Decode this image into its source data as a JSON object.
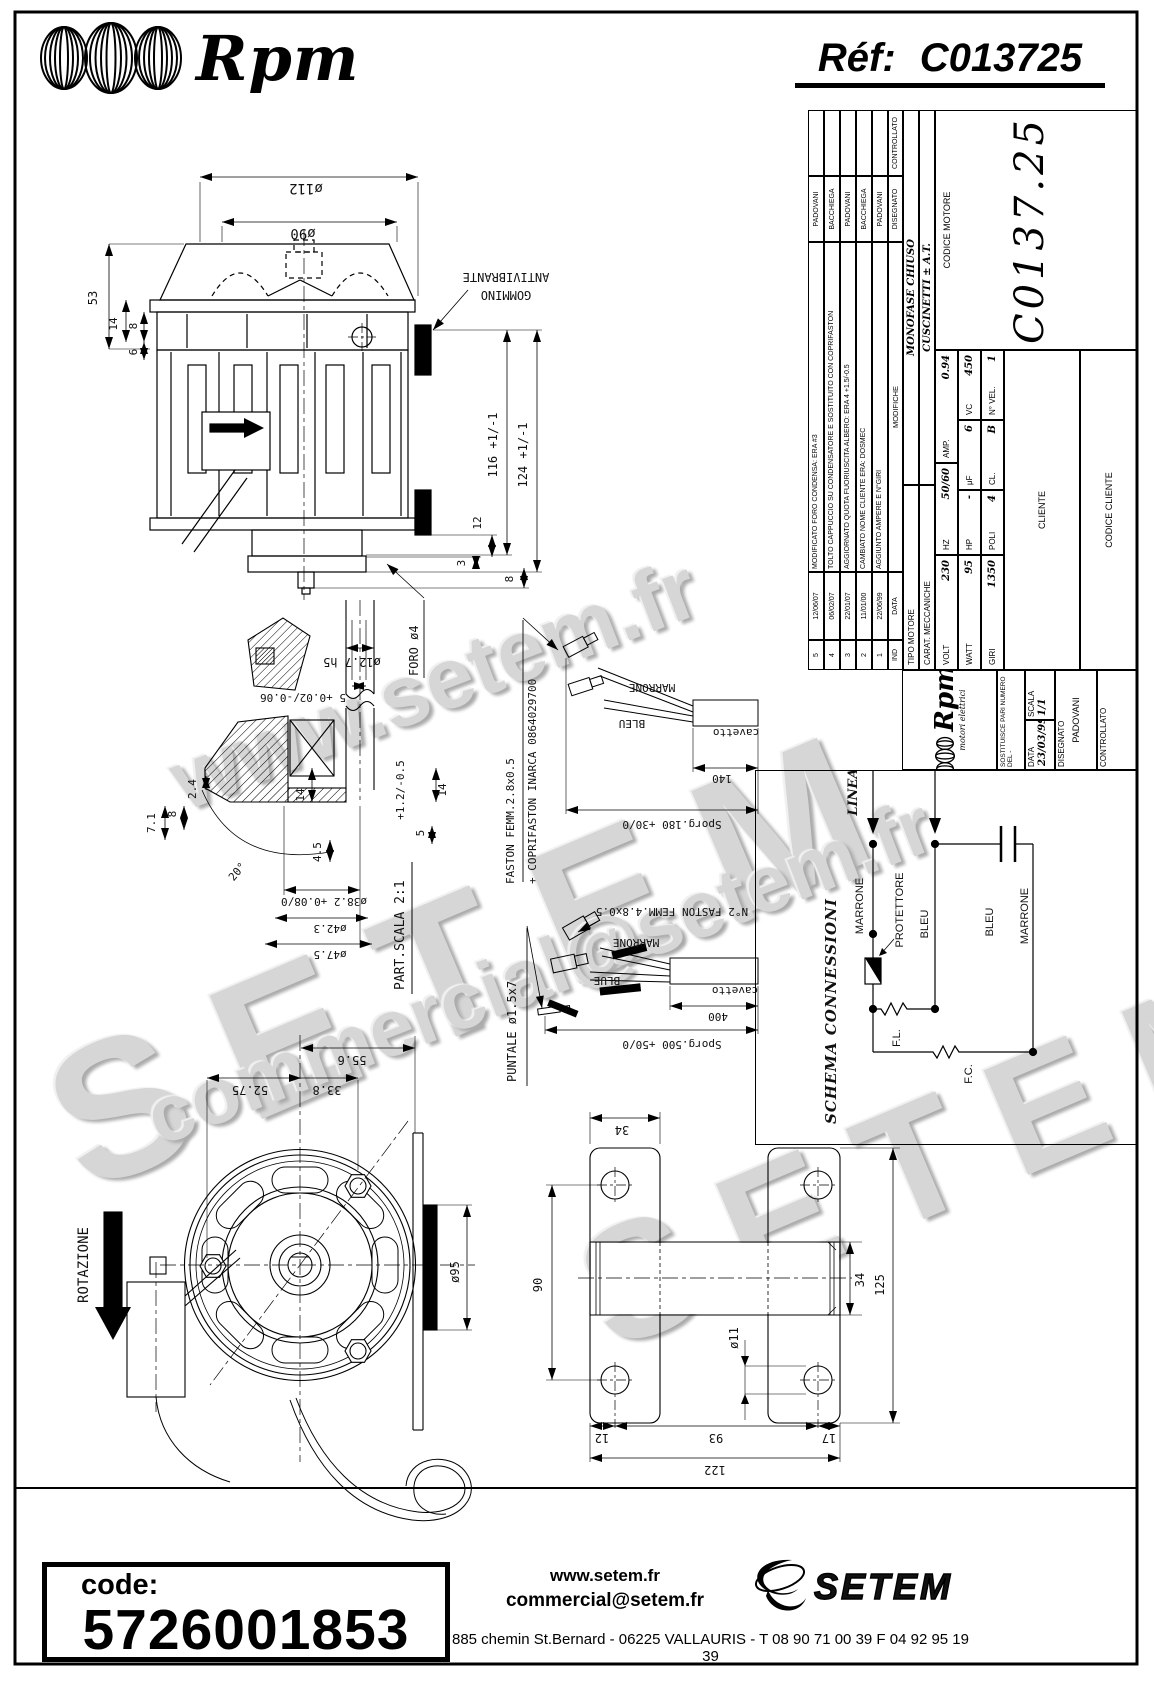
{
  "header": {
    "brand": "Rpm",
    "ref_label": "Réf:",
    "ref_value": "C013725"
  },
  "wm": {
    "a": "www.setem.fr",
    "b": "SETEM",
    "c": "commercial@setem.fr",
    "d": "SETEM"
  },
  "side": {
    "d112": "ø112",
    "d90": "ø90",
    "d53": "53",
    "d14": "14",
    "d8": "8",
    "d6": "6",
    "d116": "116 +1/-1",
    "d124": "124 +1/-1",
    "d12": "12",
    "d3": "3",
    "d8b": "8",
    "gommino1": "GOMMINO",
    "gommino2": "ANTIVIBRANTE",
    "foro": "FORO ø4"
  },
  "detail": {
    "title": "PART.SCALA 2:1",
    "d1": "ø12.7 h5",
    "d2": "5 +0.02/-0.06",
    "d3": "2.4",
    "d4": "7.1",
    "d5": "8",
    "d6": "14",
    "d7": "4.5",
    "d8": "20°",
    "d9": "+1.2/-0.5",
    "d10": "14",
    "d11": "5",
    "d12": "ø38.2 +0.08/0",
    "d13": "ø42.3",
    "d14": "ø47.5"
  },
  "cab1": {
    "l1": "FASTON FEMM.2.8x0.5",
    "l2": "+ COPRIFASTON INARCA 0864029700",
    "marrone": "MARRONE",
    "bleu": "BLEU",
    "cavetto": "cavetto",
    "len": "140",
    "sporg": "Sporg.180 +30/0"
  },
  "cab2": {
    "l1": "N°2 FASTON FEMM.4.8x0.5",
    "puntale": "PUNTALE ø1.5x7",
    "marrone": "MARRONE",
    "blue": "BLUE",
    "cavetto": "cavetto",
    "len": "400",
    "sporg": "Sporg.500 +50/0"
  },
  "front": {
    "rotazione": "ROTAZIONE",
    "d556": "55.6",
    "d5275": "52.75",
    "d338": "33.8",
    "d95": "ø95"
  },
  "bracket": {
    "d34t": "34",
    "d90": "90",
    "d11": "ø11",
    "d34r": "34",
    "d125": "125",
    "d12": "12",
    "d93": "93",
    "d17": "17",
    "d122": "122"
  },
  "schema": {
    "title": "SCHEMA CONNESSIONI",
    "linea": "LINEA",
    "marrone1": "MARRONE",
    "protettore": "PROTETTORE",
    "bleu1": "BLEU",
    "bleu2": "BLEU",
    "marrone2": "MARRONE",
    "fl": "F.L.",
    "fc": "F.C."
  },
  "tb": {
    "rev": [
      {
        "ind": "5",
        "data": "12/06/07",
        "mod": "MODIFICATO FORO CONDENSA: ERA #3",
        "dis": "PADOVANI"
      },
      {
        "ind": "4",
        "data": "06/02/07",
        "mod": "TOLTO CAPPUCCIO SU CONDENSATORE E SOSTITUITO CON COPRIFASTON",
        "dis": "BACCHIEGA"
      },
      {
        "ind": "3",
        "data": "22/01/07",
        "mod": "AGGIORNATO QUOTA FUORIUSCITA ALBERO: ERA 4 +1.5/-0.5",
        "dis": "PADOVANI"
      },
      {
        "ind": "2",
        "data": "11/01/00",
        "mod": "CAMBIATO NOME CLIENTE ERA: DOSMEC",
        "dis": "BACCHIEGA"
      },
      {
        "ind": "1",
        "data": "22/06/99",
        "mod": "AGGIUNTO AMPERE E N°GIRI",
        "dis": "PADOVANI"
      }
    ],
    "revh": {
      "ind": "IND",
      "data": "DATA",
      "mod": "MODIFICHE",
      "dis": "DISEGNATO",
      "ctrl": "CONTROLLATO"
    },
    "tipo_l": "TIPO MOTORE",
    "tipo_v": "MONOFASE CHIUSO",
    "carat_l": "CARAT. MECCANICHE",
    "carat_v": "CUSCINETTI ± A.T.",
    "volt_l": "VOLT",
    "volt": "230",
    "hz_l": "HZ",
    "hz": "50/60",
    "amp_l": "AMP.",
    "amp": "0.94",
    "watt_l": "WATT",
    "watt": "95",
    "hp_l": "HP",
    "hp": "-",
    "uf_l": "μF",
    "uf": "6",
    "vc_l": "VC",
    "vc": "450",
    "giri_l": "GIRI",
    "giri": "1350",
    "poli_l": "POLI",
    "poli": "4",
    "cl_l": "CL.",
    "cl": "B",
    "nvel_l": "N° VEL.",
    "nvel": "1",
    "cliente_l": "CLIENTE",
    "cod_cliente_l": "CODICE CLIENTE",
    "cod_motore_l": "CODICE MOTORE",
    "cod_motore": "C0137.25",
    "brand": "Rpm",
    "brand_sub": "motori elettrici",
    "sost": "SOSTITUISCE PARI NUMERO DEL  -",
    "data_l": "DATA",
    "data_v": "23/03/99",
    "scala_l": "SCALA",
    "scala_v": "1/1",
    "dis_l": "DISEGNATO",
    "dis_v": "PADOVANI",
    "ctrl_l": "CONTROLLATO"
  },
  "code": {
    "label": "code:",
    "value": "5726001853"
  },
  "footer": {
    "web": "www.setem.fr",
    "email": "commercial@setem.fr",
    "brand": "SETEM",
    "address": "885 chemin St.Bernard  -  06225 VALLAURIS  -  T 08 90 71 00 39   F 04 92 95 19 39"
  }
}
